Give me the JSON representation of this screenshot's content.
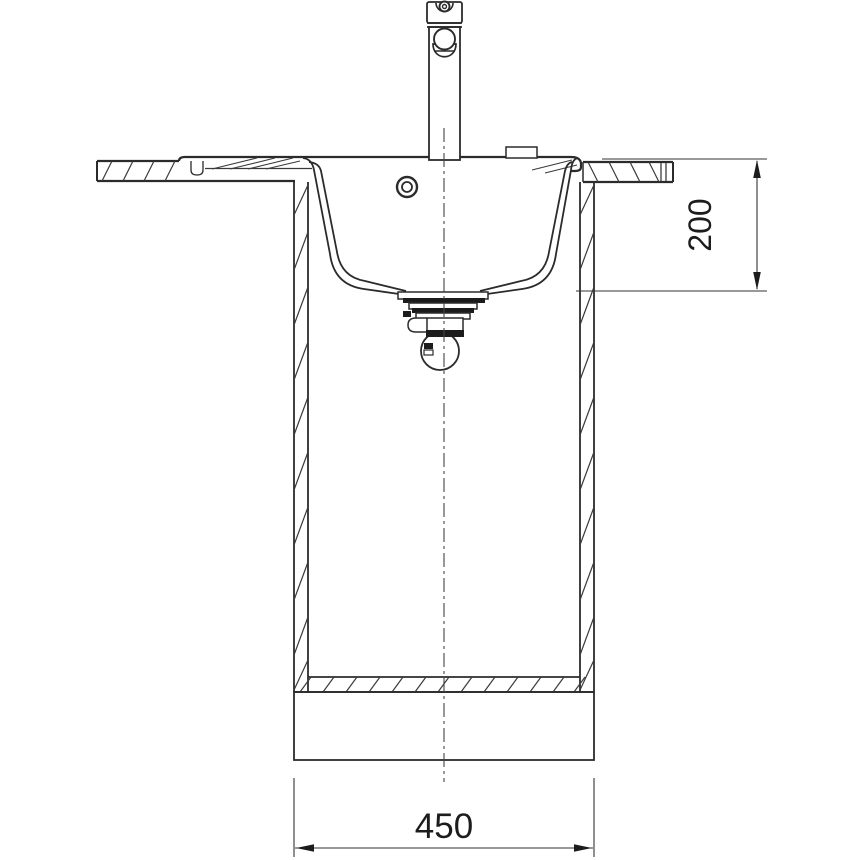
{
  "drawing": {
    "kind": "sink-installation-cross-section",
    "background_color": "#ffffff",
    "line_color": "#2b2b2b",
    "thin_line_color": "#3a3a3a",
    "dimensions": {
      "bowl_depth": {
        "value": "200",
        "orientation": "vertical-rotated-90"
      },
      "cabinet_width": {
        "value": "450",
        "orientation": "horizontal"
      }
    }
  }
}
